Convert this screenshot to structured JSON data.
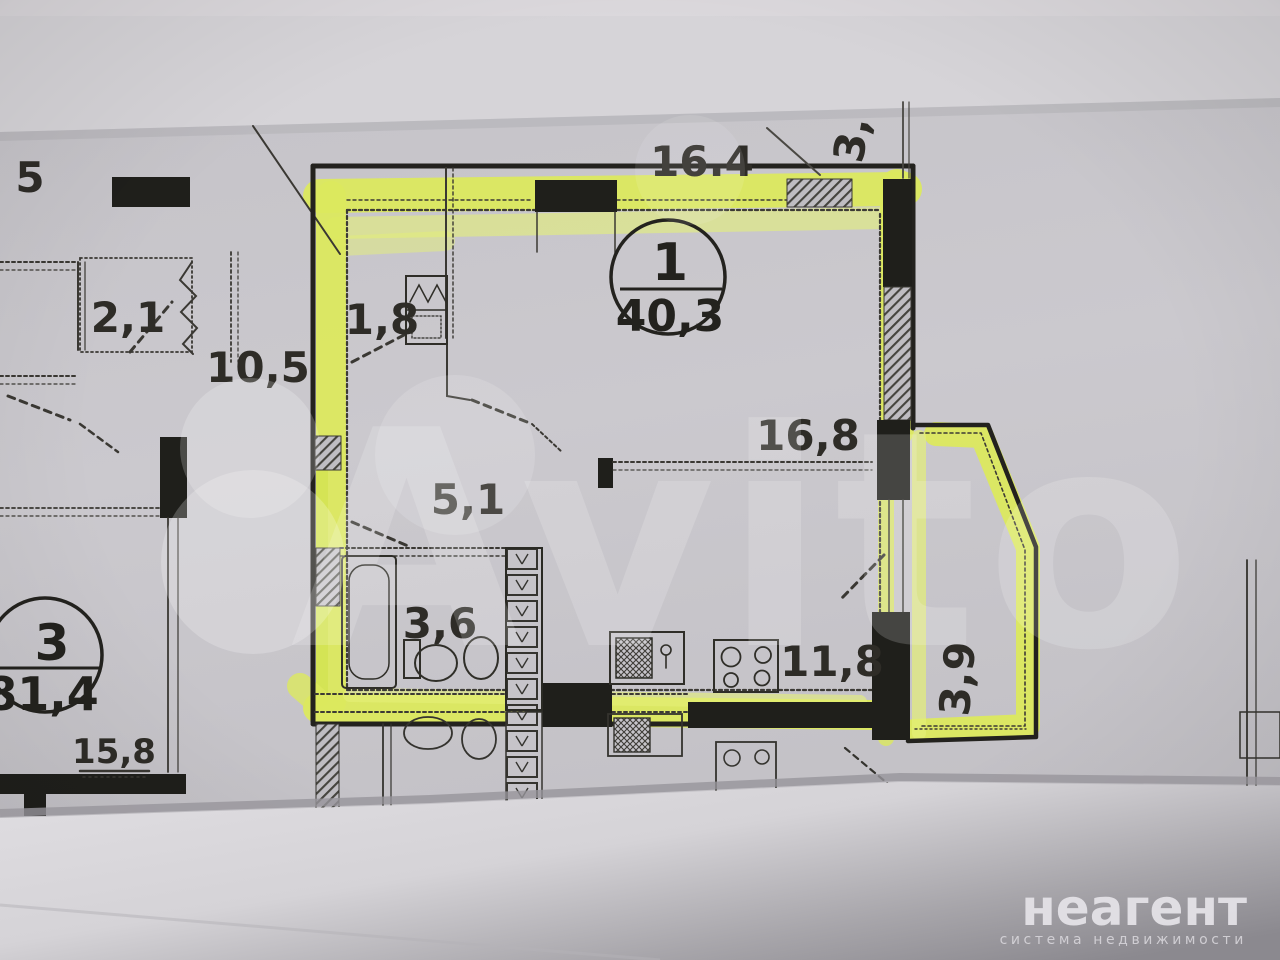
{
  "branding": {
    "watermark": "Avito",
    "logo_title": "неагент",
    "logo_subtitle": "система недвижимости"
  },
  "units": {
    "highlighted": {
      "number": "1",
      "area": "40,3"
    },
    "neighbor": {
      "number": "3",
      "area": "81,4"
    }
  },
  "dimensions": {
    "top_total": "16.4",
    "top_right_vertical": "3,",
    "edge_left_partial": "5",
    "neighbor_balcony": "2,1",
    "neighbor_upper_room": "10,5",
    "entry_nook": "1,8",
    "hallway": "5,1",
    "bathroom": "3,6",
    "living_room": "16,8",
    "kitchen": "11,8",
    "balcony": "3,9",
    "neighbor_lower_room": "15,8"
  },
  "colors": {
    "highlighter": "#dce95e",
    "wall_ink": "#23221e",
    "paper": "#c8c6cb"
  }
}
